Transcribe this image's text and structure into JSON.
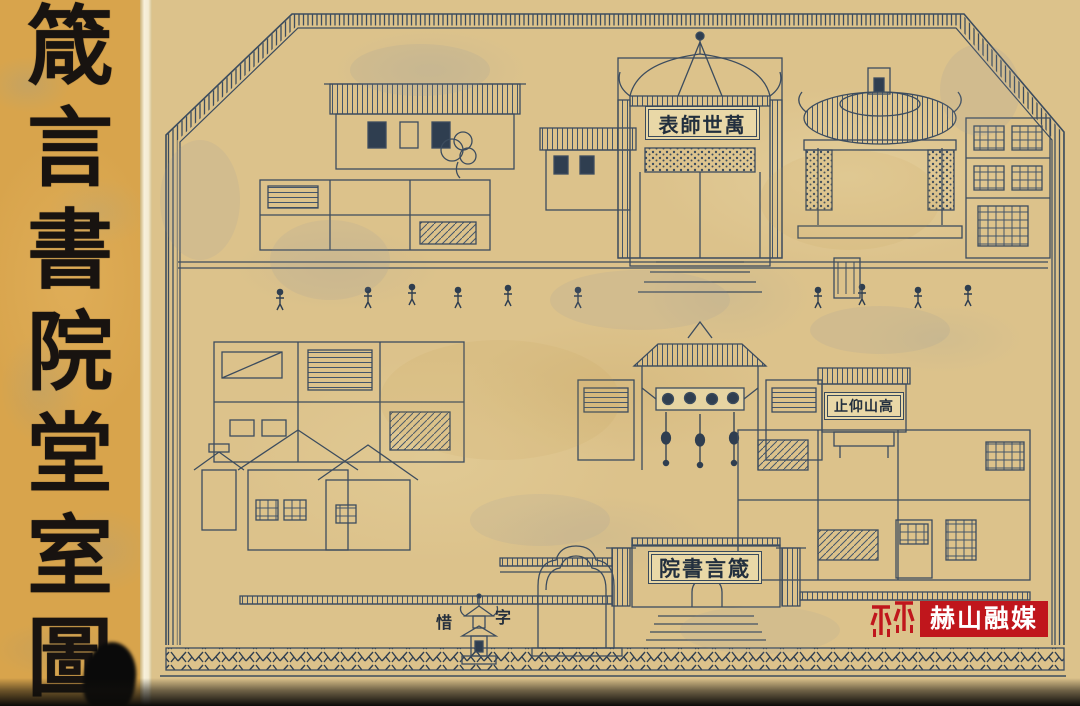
{
  "title_panel": {
    "text": "箴言書院堂室圖",
    "characters": [
      "箴",
      "言",
      "書",
      "院",
      "堂",
      "室",
      "圖"
    ]
  },
  "drawing": {
    "plaques": {
      "shrine": {
        "reading": "萬世師表",
        "display": "表師世萬"
      },
      "side_hall": {
        "reading": "高山仰止",
        "display": "止仰山高"
      },
      "main_gate": {
        "reading": "箴言書院",
        "display": "院書言箴"
      },
      "pagoda": {
        "reading": "惜字",
        "left_char": "惜",
        "right_char": "字"
      }
    }
  },
  "watermark": {
    "text": "赫山融媒"
  },
  "colors": {
    "title_paper": "#d8a44c",
    "drawing_paper": "#dcc28b",
    "ink": "#3c4c5e",
    "gutter": "#f5eed8",
    "watermark_red": "#c0161c",
    "watermark_text": "#ffffff"
  }
}
